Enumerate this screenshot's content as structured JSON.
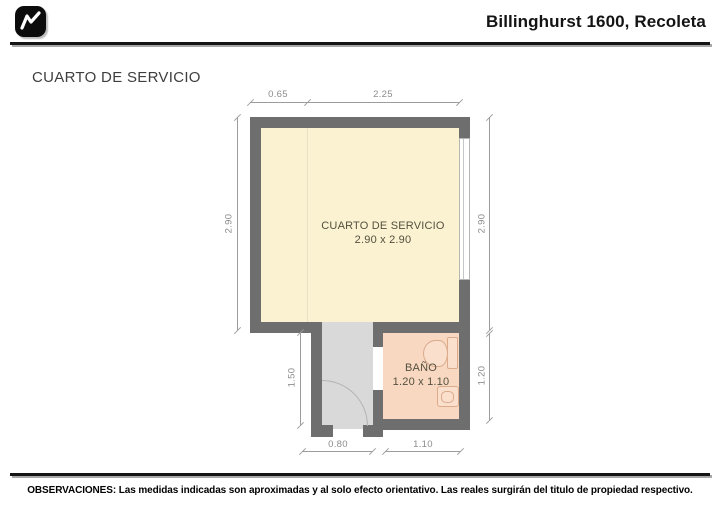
{
  "header": {
    "title": "Billinghurst 1600, Recoleta",
    "logo_icon": "trend-zigzag-icon"
  },
  "plan": {
    "title": "CUARTO DE SERVICIO",
    "rooms": {
      "main": {
        "name": "CUARTO DE SERVICIO",
        "size": "2.90 x 2.90"
      },
      "bathroom": {
        "name": "BAÑO",
        "size": "1.20 x 1.10"
      }
    },
    "dimensions": {
      "top_left": "0.65",
      "top_right": "2.25",
      "left": "2.90",
      "right": "2.90",
      "hall_height": "1.50",
      "bath_height": "1.20",
      "hall_width": "0.80",
      "bath_width": "1.10"
    },
    "colors": {
      "wall": "#6e6e6e",
      "room_fill": "#fbf2d1",
      "bath_fill": "#f8d8c1",
      "hall_fill": "#d9d9d9",
      "fixture_line": "#dcab8c",
      "dim_line": "#9c9c9c",
      "dim_text": "#8c8c8c",
      "label_text": "#54503f"
    }
  },
  "footer": {
    "disclaimer": "OBSERVACIONES: Las medidas indicadas son aproximadas y al solo efecto orientativo. Las reales surgirán del titulo de propiedad respectivo."
  }
}
